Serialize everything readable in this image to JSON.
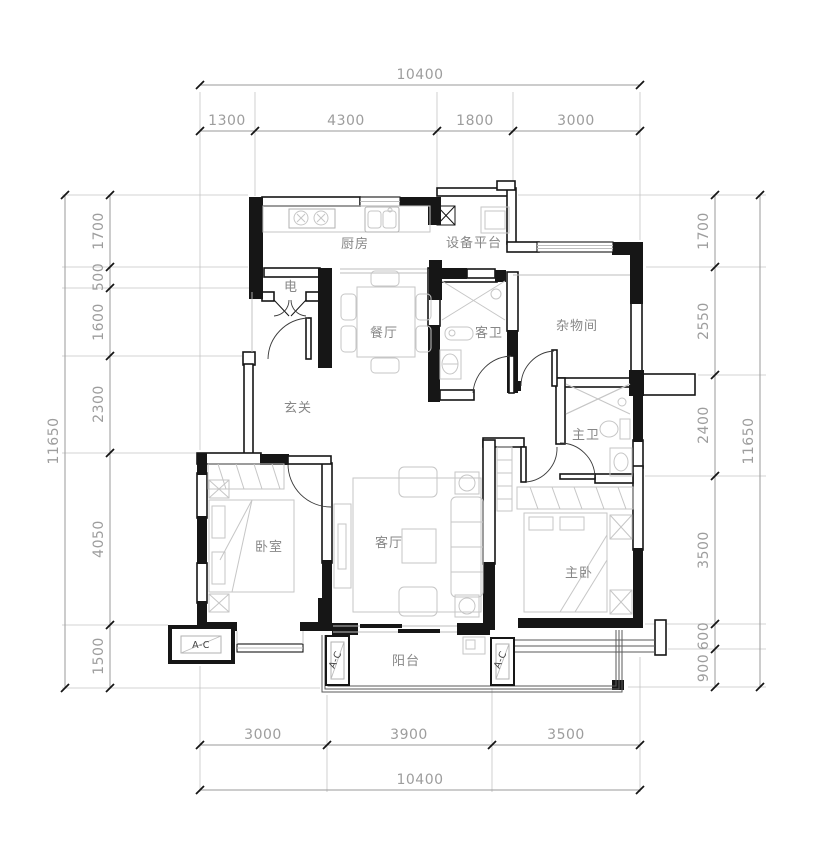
{
  "rooms": {
    "kitchen": "厨房",
    "equipment_platform": "设备平台",
    "electrical": "电",
    "dining": "餐厅",
    "guest_bath": "客卫",
    "storage": "杂物间",
    "entry": "玄关",
    "master_bath": "主卫",
    "bedroom": "卧室",
    "living": "客厅",
    "master_bedroom": "主卧",
    "balcony": "阳台"
  },
  "ac_units": [
    "A-C",
    "A-C",
    "A-C"
  ],
  "dims": {
    "top": {
      "total": "10400",
      "segments": [
        "1300",
        "4300",
        "1800",
        "3000"
      ]
    },
    "bottom": {
      "total": "10400",
      "segments": [
        "3000",
        "3900",
        "3500"
      ]
    },
    "left": {
      "total": "11650",
      "segments": [
        "1700",
        "500",
        "1600",
        "2300",
        "4050",
        "1500"
      ]
    },
    "right": {
      "total": "11650",
      "segments": [
        "1700",
        "2550",
        "2400",
        "3500",
        "600",
        "900"
      ]
    }
  }
}
